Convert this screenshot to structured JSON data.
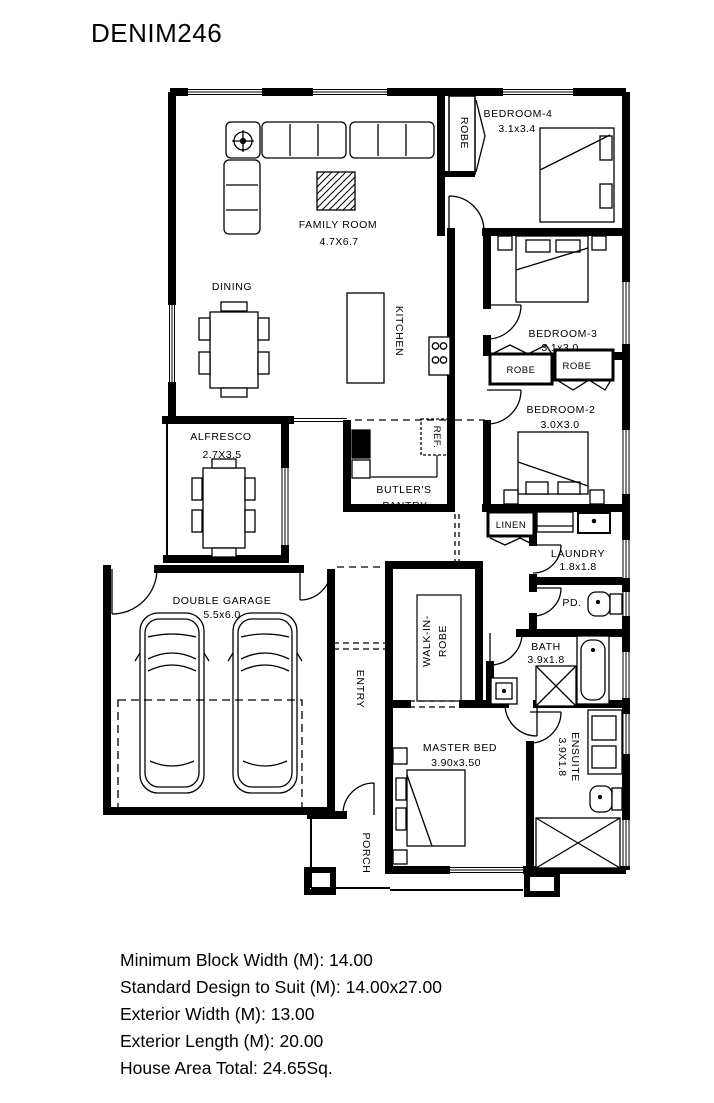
{
  "title": "DENIM246",
  "plan": {
    "rooms": {
      "family_room": {
        "name": "FAMILY ROOM",
        "size": "4.7X6.7"
      },
      "dining": {
        "name": "DINING"
      },
      "kitchen": {
        "name": "KITCHEN"
      },
      "bedroom4": {
        "name": "BEDROOM-4",
        "size": "3.1x3.4"
      },
      "bedroom4_robe": {
        "name": "ROBE"
      },
      "bedroom3": {
        "name": "BEDROOM-3",
        "size": "3.1x3.0"
      },
      "robe_left": {
        "name": "ROBE"
      },
      "robe_right": {
        "name": "ROBE"
      },
      "bedroom2": {
        "name": "BEDROOM-2",
        "size": "3.0X3.0"
      },
      "alfresco": {
        "name": "ALFRESCO",
        "size": "2.7X3.5"
      },
      "butlers_pantry": {
        "line1": "BUTLER'S",
        "line2": "PANTRY"
      },
      "fridge": {
        "name": "REF."
      },
      "linen": {
        "name": "LINEN"
      },
      "laundry": {
        "name": "LAUNDRY",
        "size": "1.8x1.8"
      },
      "powder": {
        "name": "PD."
      },
      "garage": {
        "name": "DOUBLE GARAGE",
        "size": "5.5x6.0"
      },
      "walk_in_robe": {
        "line1": "WALK-IN-",
        "line2": "ROBE"
      },
      "entry": {
        "name": "ENTRY"
      },
      "bath": {
        "name": "BATH",
        "size": "3.9x1.8"
      },
      "master_bed": {
        "name": "MASTER BED",
        "size": "3.90x3.50"
      },
      "ensuite": {
        "name": "ENSUITE",
        "size": "3.9X1.8"
      },
      "porch": {
        "name": "PORCH"
      }
    }
  },
  "specs": {
    "min_block_width": "Minimum Block Width (M): 14.00",
    "standard_design": "Standard Design to Suit (M): 14.00x27.00",
    "exterior_width": "Exterior Width (M): 13.00",
    "exterior_length": "Exterior Length (M): 20.00",
    "house_area_total": "House Area Total: 24.65Sq."
  },
  "colors": {
    "ink": "#000000",
    "paper": "#ffffff"
  }
}
